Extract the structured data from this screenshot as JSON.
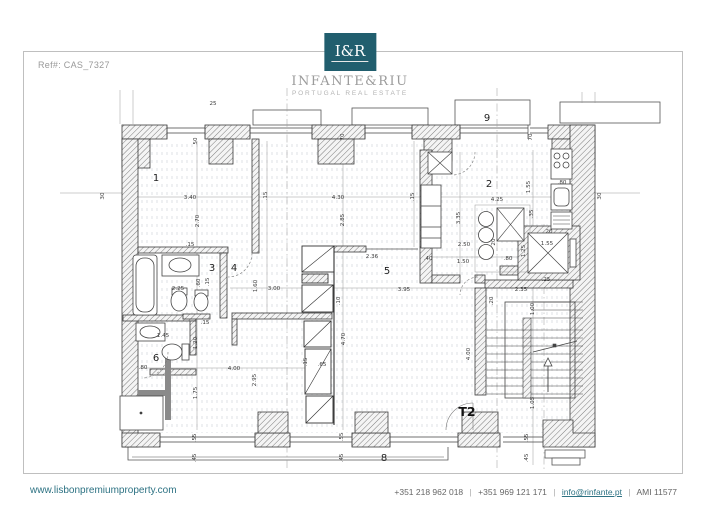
{
  "page": {
    "ref_label": "Ref#: CAS_7327"
  },
  "logo": {
    "monogram": "I&R",
    "name": "INFANTE&RIU",
    "tagline": "PORTUGAL REAL ESTATE",
    "brand_color": "#215e6e"
  },
  "footer": {
    "website": "www.lisbonpremiumproperty.com",
    "phone1": "+351 218 962 018",
    "phone2": "+351 969 121 171",
    "email": "info@rinfante.pt",
    "license": "AMI 11577",
    "separator": "|",
    "link_color": "#2d7283"
  },
  "plan": {
    "unit_label": "T2",
    "unit_label_pos": {
      "x": 467,
      "y": 416
    },
    "rooms": [
      {
        "n": "1",
        "x": 156,
        "y": 181
      },
      {
        "n": "2",
        "x": 489,
        "y": 187
      },
      {
        "n": "3",
        "x": 212,
        "y": 271
      },
      {
        "n": "4",
        "x": 234,
        "y": 271
      },
      {
        "n": "5",
        "x": 387,
        "y": 274
      },
      {
        "n": "6",
        "x": 156,
        "y": 361
      },
      {
        "n": "8",
        "x": 384,
        "y": 461
      },
      {
        "n": "9",
        "x": 487,
        "y": 121
      }
    ],
    "dimensions": [
      {
        "t": "25",
        "x": 213,
        "y": 105
      },
      {
        "t": "50",
        "x": 197,
        "y": 141,
        "v": 1
      },
      {
        "t": "30",
        "x": 104,
        "y": 196,
        "v": 1
      },
      {
        "t": "30",
        "x": 601,
        "y": 196,
        "v": 1
      },
      {
        "t": "70",
        "x": 344,
        "y": 137,
        "v": 1
      },
      {
        "t": "70",
        "x": 532,
        "y": 137,
        "v": 1
      },
      {
        "t": "3.40",
        "x": 190,
        "y": 199
      },
      {
        "t": "2.70",
        "x": 199,
        "y": 221,
        "v": 1
      },
      {
        "t": ".15",
        "x": 267,
        "y": 196,
        "v": 1
      },
      {
        "t": "4.30",
        "x": 338,
        "y": 199
      },
      {
        "t": "2.85",
        "x": 344,
        "y": 220,
        "v": 1
      },
      {
        "t": ".15",
        "x": 414,
        "y": 197,
        "v": 1
      },
      {
        "t": "4.25",
        "x": 497,
        "y": 201
      },
      {
        "t": "1.55",
        "x": 530,
        "y": 187,
        "v": 1
      },
      {
        "t": ".80",
        "x": 562,
        "y": 184
      },
      {
        "t": "3.35",
        "x": 460,
        "y": 218,
        "v": 1
      },
      {
        "t": ".35",
        "x": 533,
        "y": 214,
        "v": 1
      },
      {
        "t": "2.50",
        "x": 464,
        "y": 246
      },
      {
        "t": "1.50",
        "x": 463,
        "y": 263
      },
      {
        "t": ".40",
        "x": 428,
        "y": 260
      },
      {
        "t": ".80",
        "x": 508,
        "y": 260
      },
      {
        "t": "20",
        "x": 495,
        "y": 242,
        "v": 1
      },
      {
        "t": "20",
        "x": 549,
        "y": 233
      },
      {
        "t": "1.55",
        "x": 547,
        "y": 245
      },
      {
        "t": "1.25",
        "x": 525,
        "y": 251,
        "v": 1
      },
      {
        "t": ".25",
        "x": 546,
        "y": 281
      },
      {
        "t": "2.36",
        "x": 372,
        "y": 258
      },
      {
        "t": "3.95",
        "x": 404,
        "y": 291
      },
      {
        "t": "2.35",
        "x": 521,
        "y": 291
      },
      {
        "t": ".20",
        "x": 493,
        "y": 301,
        "v": 1
      },
      {
        "t": "1.00",
        "x": 534,
        "y": 309,
        "v": 1
      },
      {
        "t": "4.00",
        "x": 470,
        "y": 354,
        "v": 1
      },
      {
        "t": "1.05",
        "x": 534,
        "y": 403,
        "v": 1
      },
      {
        "t": ".55",
        "x": 528,
        "y": 438,
        "v": 1
      },
      {
        "t": ".45",
        "x": 528,
        "y": 458,
        "v": 1
      },
      {
        "t": "2.25",
        "x": 178,
        "y": 290
      },
      {
        "t": ".60",
        "x": 200,
        "y": 283,
        "v": 1
      },
      {
        "t": ".15",
        "x": 209,
        "y": 282,
        "v": 1
      },
      {
        "t": ".15",
        "x": 190,
        "y": 246
      },
      {
        "t": "1.45",
        "x": 163,
        "y": 337
      },
      {
        "t": ".80",
        "x": 143,
        "y": 369
      },
      {
        "t": "1.20",
        "x": 197,
        "y": 343,
        "v": 1
      },
      {
        "t": "1.75",
        "x": 197,
        "y": 393,
        "v": 1
      },
      {
        "t": "4.00",
        "x": 234,
        "y": 370
      },
      {
        "t": "2.95",
        "x": 256,
        "y": 380,
        "v": 1
      },
      {
        "t": "3.00",
        "x": 274,
        "y": 290
      },
      {
        "t": "1.60",
        "x": 257,
        "y": 286,
        "v": 1
      },
      {
        "t": ".10",
        "x": 340,
        "y": 301,
        "v": 1
      },
      {
        "t": "4.70",
        "x": 345,
        "y": 339,
        "v": 1
      },
      {
        "t": ".15",
        "x": 307,
        "y": 362,
        "v": 1
      },
      {
        "t": ".65",
        "x": 322,
        "y": 366
      },
      {
        "t": ".15",
        "x": 205,
        "y": 324
      },
      {
        "t": ".55",
        "x": 196,
        "y": 438,
        "v": 1
      },
      {
        "t": ".45",
        "x": 196,
        "y": 458,
        "v": 1
      },
      {
        "t": ".55",
        "x": 343,
        "y": 437,
        "v": 1
      },
      {
        "t": ".45",
        "x": 343,
        "y": 458,
        "v": 1
      }
    ]
  }
}
